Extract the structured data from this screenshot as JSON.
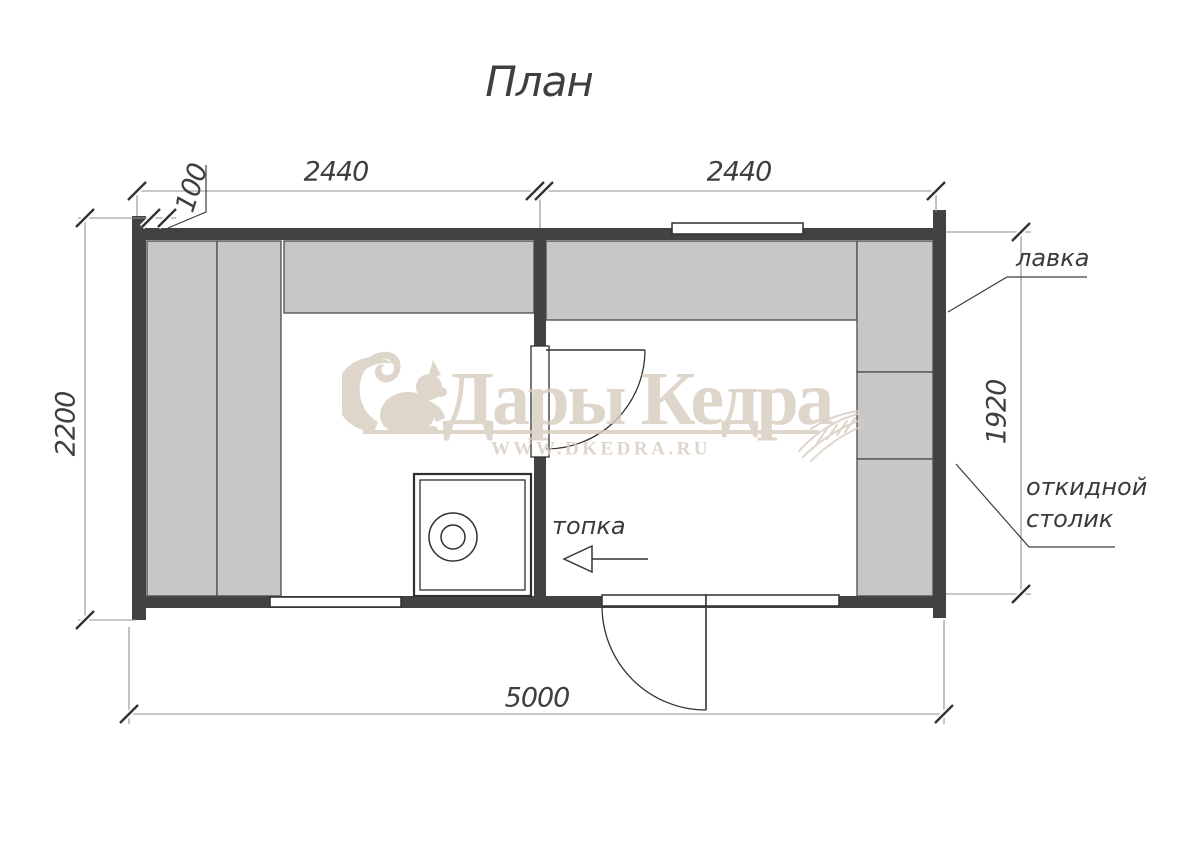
{
  "title": "План",
  "dimensions": {
    "room_left_length": "2440",
    "room_right_length": "2440",
    "wall_thickness": "100",
    "building_width": "2200",
    "interior_height": "1920",
    "total_length": "5000"
  },
  "labels": {
    "bench": "лавка",
    "folding_table_line1": "откидной",
    "folding_table_line2": "столик",
    "firebox": "топка"
  },
  "watermark": {
    "brand": "Дары Кедра",
    "site": "WWW.DKEDRA.RU"
  },
  "colors": {
    "wall": "#424242",
    "bench_fill": "#c7c7c7",
    "bench_stroke": "#4a4a4a",
    "dimension_line": "#8f8f8f",
    "drawing_line": "#333333",
    "watermark": "#d7cdc0",
    "background": "#ffffff"
  }
}
